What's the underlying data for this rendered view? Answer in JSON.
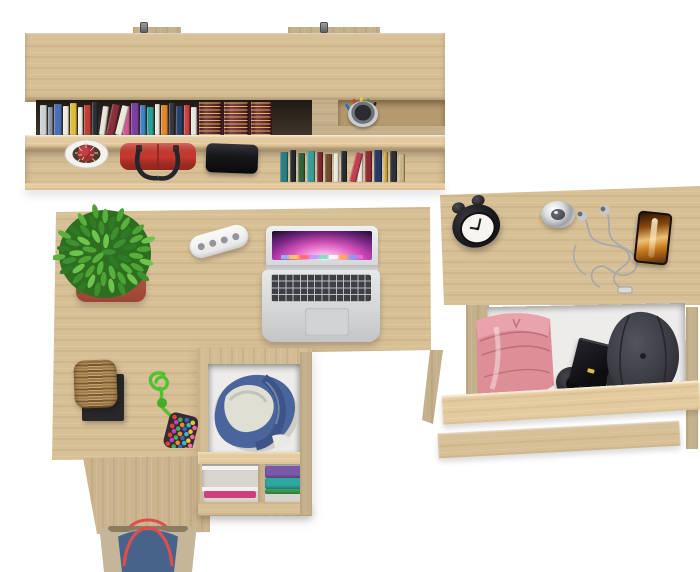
{
  "scene": {
    "label": "top view of oak home-office set: wall shelf with books, corner desk with laptop, open clothes drawers, nightstand",
    "background": "#ffffff"
  },
  "palette": {
    "wood": "#d7bf96",
    "wood_light": "#e6d5b2",
    "wood_dark": "#c2a87a",
    "wood_deep": "#ab9064",
    "interior": "#edecea",
    "mat": "#28282b",
    "basket": "#a5804e",
    "red_bag": "#c9392f",
    "speaker": "#17181b",
    "pot_clay": "#c05e4c",
    "pot_white": "#f4f3f0",
    "leaf_base": "#2e6e1f",
    "denim": "#4a659c",
    "lining": "#dfe0d3",
    "pink": "#dd8e96",
    "pink_light": "#e9a3ac",
    "pink_dark": "#bf6f7b",
    "cap": "#3b3b42",
    "chrome": "#d4d6d9",
    "clock": "#1d1d20",
    "clock_face": "#f7f5ef",
    "wire": "#a5a7ab",
    "tan": "#c5b69a",
    "tote_blue": "#47638a",
    "strap_red": "#dd4f4a",
    "rope": "#4fc22e",
    "pouch": "#372c32",
    "box": "#141417",
    "gold_chip": "#dcbe3e"
  },
  "wall_shelf": {
    "label": "wall-mounted shelf with two metal hooks",
    "hooks": 2,
    "books_top": [
      {
        "c": "#cdd1d6",
        "w": 7,
        "h": 30
      },
      {
        "c": "#8d95a2",
        "w": 5,
        "h": 28
      },
      {
        "c": "#4a6fb4",
        "w": 8,
        "h": 31
      },
      {
        "c": "#eee9df",
        "w": 6,
        "h": 29
      },
      {
        "c": "#dfbe3e",
        "w": 7,
        "h": 32
      },
      {
        "c": "#f0ede5",
        "w": 5,
        "h": 28
      },
      {
        "c": "#c23f36",
        "w": 7,
        "h": 30
      },
      {
        "c": "#2c2f36",
        "w": 6,
        "h": 33
      },
      {
        "c": "#e9e5da",
        "w": 6,
        "h": 29,
        "r": 8
      },
      {
        "c": "#8a2f3c",
        "w": 8,
        "h": 31,
        "r": 12
      },
      {
        "c": "#ece8de",
        "w": 7,
        "h": 30,
        "r": 14
      },
      {
        "c": "#d1548f",
        "w": 7,
        "h": 29
      },
      {
        "c": "#7b3ea1",
        "w": 8,
        "h": 32
      },
      {
        "c": "#3f83c0",
        "w": 6,
        "h": 30
      },
      {
        "c": "#2aa095",
        "w": 7,
        "h": 28
      },
      {
        "c": "#ede9e0",
        "w": 5,
        "h": 31
      },
      {
        "c": "#e2872f",
        "w": 7,
        "h": 30
      },
      {
        "c": "#343740",
        "w": 6,
        "h": 32
      },
      {
        "c": "#27406d",
        "w": 7,
        "h": 29
      },
      {
        "c": "#ca4242",
        "w": 6,
        "h": 30
      },
      {
        "c": "#e9e6de",
        "w": 6,
        "h": 28
      },
      {
        "c": "#5f1d28",
        "w": 22,
        "h": 34,
        "gold": true
      },
      {
        "c": "#6b2230",
        "w": 24,
        "h": 33,
        "gold": true
      },
      {
        "c": "#671f2b",
        "w": 20,
        "h": 34,
        "gold": true
      }
    ],
    "books_bottom": [
      {
        "c": "#2c7d80",
        "w": 8,
        "h": 30
      },
      {
        "c": "#26282e",
        "w": 6,
        "h": 32
      },
      {
        "c": "#33613c",
        "w": 7,
        "h": 29
      },
      {
        "c": "#3a9e97",
        "w": 8,
        "h": 31
      },
      {
        "c": "#7c2634",
        "w": 6,
        "h": 30
      },
      {
        "c": "#6f4b31",
        "w": 7,
        "h": 28
      },
      {
        "c": "#eae7df",
        "w": 5,
        "h": 29
      },
      {
        "c": "#2a2c32",
        "w": 6,
        "h": 31
      },
      {
        "c": "#c04052",
        "w": 7,
        "h": 30,
        "r": 14
      },
      {
        "c": "#ebe8e1",
        "w": 5,
        "h": 28
      },
      {
        "c": "#8e2c38",
        "w": 7,
        "h": 31
      },
      {
        "c": "#273a66",
        "w": 8,
        "h": 32
      },
      {
        "c": "#caa23a",
        "w": 4,
        "h": 30
      },
      {
        "c": "#2f3138",
        "w": 7,
        "h": 31
      },
      {
        "c": "#c9b283",
        "w": 6,
        "h": 28
      }
    ],
    "pen_colors": [
      "#2b6fc4",
      "#d23b33",
      "#e8c93c",
      "#3f9a45",
      "#26262b",
      "#d77a2c"
    ],
    "items": [
      "white-pot-red-cactus",
      "red-handbag",
      "black-speaker",
      "pen-cup"
    ]
  },
  "desk": {
    "label": "corner desk",
    "items": [
      "potted-plant",
      "cable-organizer",
      "open-laptop",
      "wicker-basket-on-mat",
      "bead-keychain"
    ],
    "leaf_colors": [
      "#3e8f2f",
      "#58b13e",
      "#6ec44f",
      "#2f7a26",
      "#4da334"
    ],
    "bead_colors": [
      "#e04338",
      "#3fae5c",
      "#3a64c8",
      "#efc93c",
      "#c23ec2",
      "#ef8a33",
      "#39bcbc",
      "#ef6fa0"
    ]
  },
  "desk_drawer": {
    "label": "open desk drawer with denim clothes, lower shelf with folded clothes",
    "denim": "#4a659c",
    "shelf_clothes": [
      "#7a5aa8",
      "#2fa7a0",
      "#3f9e4f"
    ],
    "shelf_cloth_accent": "#cf3f7e"
  },
  "nightstand": {
    "label": "nightstand with open drawer",
    "top_items": [
      "alarm-clock",
      "metal-clock",
      "earbuds",
      "smartphone"
    ],
    "drawer_items": [
      "pink-folded-clothes",
      "wristwatch",
      "black-watch-box",
      "baseball-cap"
    ]
  },
  "tote_bag": {
    "label": "denim tote bag with red rope handles"
  }
}
